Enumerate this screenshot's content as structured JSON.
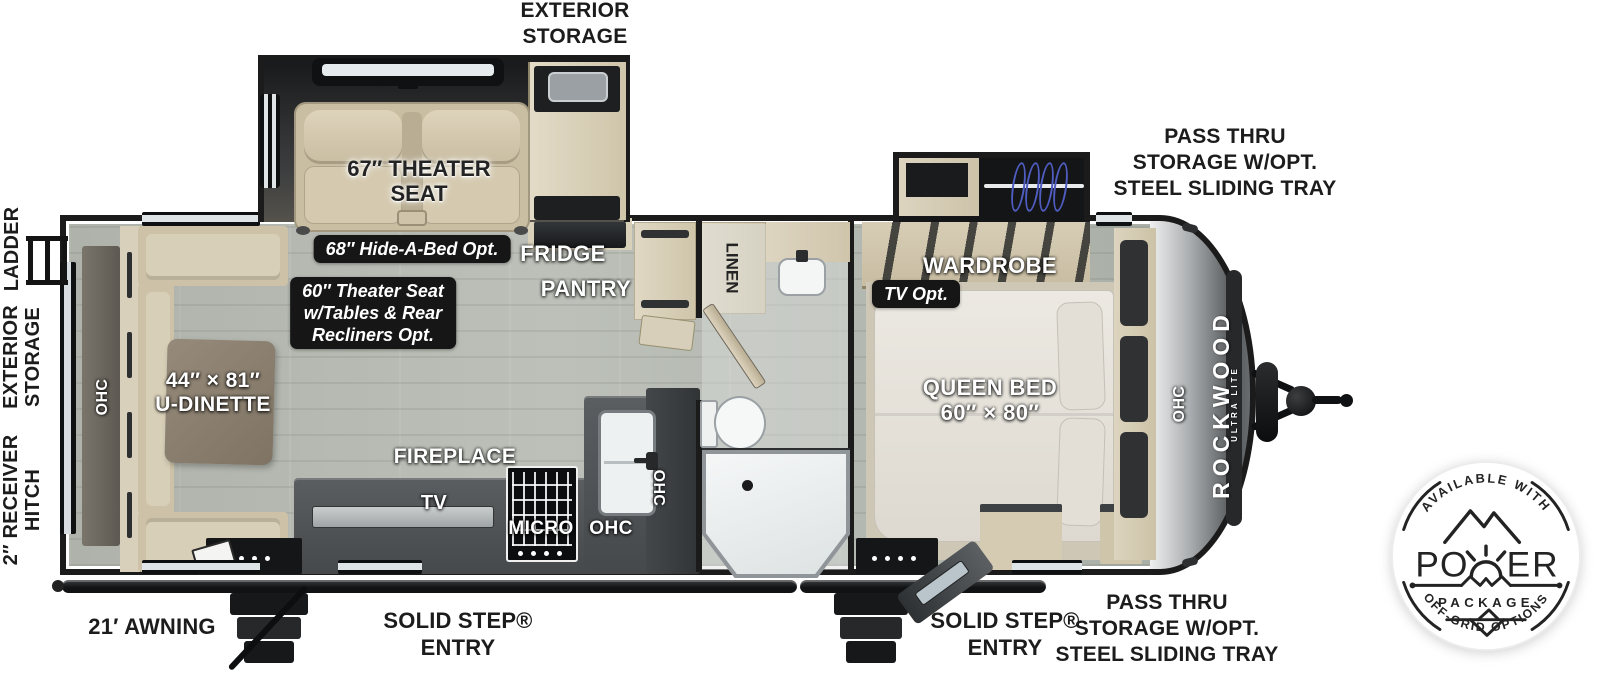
{
  "page": {
    "title": "Rockwood Ultra Lite Travel Trailer Floor Plan"
  },
  "brand": {
    "name": "ROCKWOOD",
    "series": "ULTRA LITE"
  },
  "exterior": {
    "exterior_storage_top": [
      "EXTERIOR",
      "STORAGE"
    ],
    "pass_thru_storage_top": [
      "PASS THRU",
      "STORAGE W/OPT.",
      "STEEL SLIDING TRAY"
    ],
    "pass_thru_storage_bottom": [
      "PASS THRU",
      "STORAGE W/OPT.",
      "STEEL SLIDING TRAY"
    ],
    "ladder": "LADDER",
    "exterior_storage_side": [
      "EXTERIOR",
      "STORAGE"
    ],
    "receiver_hitch": [
      "2″ RECEIVER",
      "HITCH"
    ],
    "awning": "21′ AWNING",
    "entry_door_left": [
      "SOLID STEP®",
      "ENTRY"
    ],
    "entry_door_right": [
      "SOLID STEP®",
      "ENTRY"
    ]
  },
  "interior": {
    "theater_seat": [
      "67″ THEATER",
      "SEAT"
    ],
    "hide_a_bed_option": "68″ Hide-A-Bed Opt.",
    "theater_seat_option": [
      "60″ Theater Seat",
      "w/Tables & Rear",
      "Recliners Opt."
    ],
    "fridge": "FRIDGE",
    "pantry": "PANTRY",
    "linen": "LINEN",
    "wardrobe": "WARDROBE",
    "tv_option": "TV Opt.",
    "queen_bed": [
      "QUEEN BED",
      "60″ × 80″"
    ],
    "u_dinette": [
      "44″ × 81″",
      "U-DINETTE"
    ],
    "fireplace": "FIREPLACE",
    "tv": "TV",
    "micro": "MICRO",
    "ohc": "OHC"
  },
  "power_badge": {
    "arc_top": "AVAILABLE WITH",
    "power_letters": [
      "P",
      "O",
      "E",
      "R"
    ],
    "package": "PACKAGE",
    "arc_bottom": "OFF-GRID OPTIONS"
  },
  "colors": {
    "wall_ink": "#1b1b1b",
    "floor_wood": "#b4b8b0",
    "cabinet_wood": "#d9d0ba",
    "upholstery": "#d2c7ac",
    "counter": "#515557",
    "option_box": "#161616",
    "badge_ink": "#232323",
    "hanger_blue": "#5a67c8"
  }
}
